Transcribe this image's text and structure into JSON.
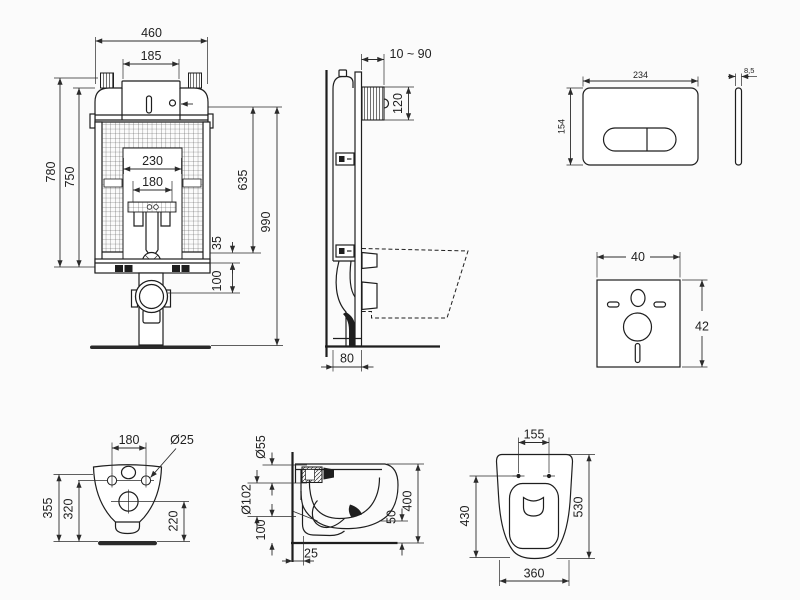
{
  "views": {
    "frame_front": {
      "width": "460",
      "rod_spacing": "185",
      "opening_width": "230",
      "opening_inner_width": "180",
      "frame_height": "780",
      "tank_height": "750",
      "flush_pipe_height": "635",
      "total_height": "990",
      "elbow_offset": "35",
      "outlet_height": "100"
    },
    "frame_side": {
      "wall_distance": "10 ~ 90",
      "inspection_box_height": "120",
      "frame_depth": "80"
    },
    "flush_plate": {
      "width": "234",
      "height": "154",
      "thickness": "8,5"
    },
    "sound_mat": {
      "width": "40",
      "height": "42"
    },
    "bowl_rear": {
      "fixing_hole_spacing": "180",
      "fixing_hole_diameter": "Ø25",
      "overall_height": "355",
      "fixing_height": "320",
      "outlet_height": "220"
    },
    "bowl_side": {
      "inlet_diameter": "Ø55",
      "outlet_diameter": "Ø102",
      "outlet_axis_height": "100",
      "wall_clearance": "25",
      "front_clearance": "50",
      "overall_height": "400"
    },
    "bowl_top": {
      "hinge_spacing": "155",
      "bowl_inner_length": "430",
      "overall_length": "530",
      "overall_width": "360"
    }
  },
  "colors": {
    "line": "#1e1e1e",
    "dim_line": "#2b2b2b",
    "background": "#fbfbfb"
  }
}
